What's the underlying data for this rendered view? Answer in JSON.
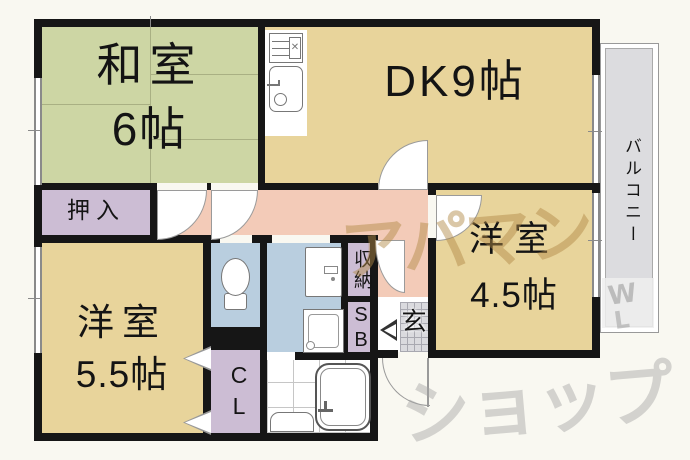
{
  "rooms": {
    "washitsu": {
      "name": "和室",
      "size": "6帖"
    },
    "dk": {
      "label": "DK9帖"
    },
    "youshitsu_55": {
      "name": "洋室",
      "size": "5.5帖"
    },
    "youshitsu_45": {
      "name": "洋室",
      "size": "4.5帖"
    },
    "oshiire": {
      "label": "押入"
    },
    "closet_cl": {
      "label": "CL"
    },
    "shuno": {
      "label": "収納"
    },
    "shoebox": {
      "label": "SB"
    },
    "genkan": {
      "label": "玄"
    },
    "balcony": {
      "label": "バルコニー"
    }
  },
  "watermark": {
    "word1": "アパマン",
    "word2": "ショップ",
    "mark_w": "W",
    "mark_l": "L"
  },
  "colors": {
    "wall": "#161616",
    "tatami_room": "#cdd6a4",
    "western_room": "#e8d49b",
    "hall": "#f3cbb8",
    "storage": "#ccbdd4",
    "sanitary": "#b9cedf",
    "genkan_tile": "#dadade",
    "balcony": "#dcdcdf",
    "watermark_tan": "#b28a48",
    "watermark_gray": "#a5a5a5"
  }
}
